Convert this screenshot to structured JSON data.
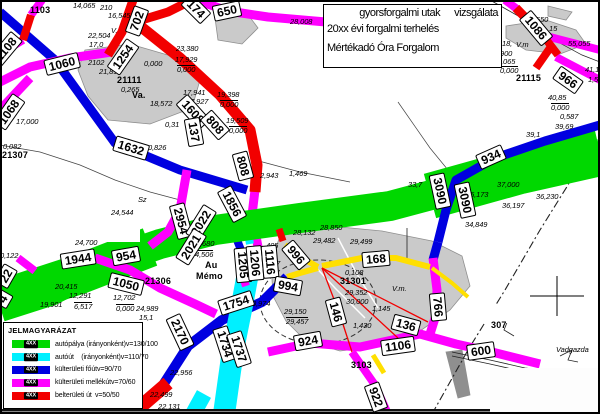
{
  "title_box": {
    "line1_left": "gyorsforgalmi utak",
    "line1_right": "vizsgálata",
    "line2": "20xx évi forgalmi terhelés",
    "line3": "Mértékadó Óra Forgalom"
  },
  "legend": {
    "title": "JELMAGYARÁZAT",
    "sample_label": "4XX",
    "items": [
      {
        "color": "green",
        "label": "autópálya (irányonként)",
        "speed": "v=130/100"
      },
      {
        "color": "cyan",
        "label": "autóút    (irányonként)",
        "speed": "v=110/70"
      },
      {
        "color": "blue",
        "label": "külterületi főút",
        "speed": "v=90/70"
      },
      {
        "color": "magenta",
        "label": "külterületi mellékút",
        "speed": "v=70/60"
      },
      {
        "color": "red",
        "label": "belterületi út",
        "speed": "v=50/50"
      }
    ]
  },
  "colors": {
    "green": "#00d800",
    "cyan": "#00f0ff",
    "blue": "#0000e0",
    "magenta": "#ff00ff",
    "red": "#f20000",
    "yellow": "#ffdf00",
    "gray_fill": "#cacaca",
    "gray_stroke": "#8f8f8f"
  },
  "map": {
    "gray_areas": [
      {
        "p": "85,50 130,44 178,58 200,80 192,108 150,124 108,120 88,96 78,70"
      },
      {
        "p": "215,18 246,12 258,28 242,44 218,40"
      },
      {
        "p": "506,26 546,20 576,30 586,44 560,54 526,50 506,38"
      },
      {
        "p": "548,6 572,12 566,20 548,16"
      },
      {
        "p": "280,236 330,226 382,231 432,241 462,256 470,286 450,310 420,331 380,346 340,351 306,341 286,321 273,296 271,262"
      },
      {
        "p": "446,352 462,350 466,372 470,395 458,398 452,375",
        "f": "#8f8f8f"
      },
      {
        "p": "100,386 128,386 138,400 124,414 100,414"
      }
    ],
    "dash_ring": {
      "cx": 318,
      "cy": 302,
      "rx": 58,
      "ry": 42
    },
    "thin_lines": [
      {
        "p": "490,0 520,17 545,35"
      },
      {
        "p": "545,35 582,55 600,62",
        "w": 0.7
      },
      {
        "p": "407,228 407,262",
        "w": 0.8
      },
      {
        "p": "0,145 40,152 80,165 115,180 150,192 180,200",
        "w": 0.7,
        "c": "#444"
      },
      {
        "p": "255,160 300,172 350,182",
        "w": 0.7,
        "c": "#444"
      },
      {
        "p": "398,102 430,148 448,170",
        "w": 0.7,
        "c": "#444"
      },
      {
        "p": "498,312 508,320 504,330 514,336",
        "w": 0.8
      },
      {
        "p": "560,356 572,350 568,360 578,362",
        "w": 0.8
      },
      {
        "p": "452,352 490,360 525,368 552,371",
        "w": 0.8
      },
      {
        "p": "452,356 490,364 525,372 550,375",
        "w": 0.8
      },
      {
        "p": "300,250 335,288 365,318",
        "c": "#fff",
        "w": 1.5
      },
      {
        "p": "338,238 358,276 378,308",
        "c": "#fff",
        "w": 1.5
      },
      {
        "p": "432,414 468,350 505,290 540,230 568,185 590,142",
        "w": 1.1,
        "d": "8 3 2 3"
      }
    ],
    "roads": [
      {
        "k": "magenta",
        "w": 9,
        "p": "255,190 252,215 258,247"
      },
      {
        "k": "blue",
        "w": 8,
        "p": "233,230 245,260"
      },
      {
        "k": "cyan",
        "w": 8,
        "p": "247,228 250,244"
      },
      {
        "k": "green",
        "w": 40,
        "p": "0,300 80,274 150,247"
      },
      {
        "k": "green",
        "w": 30,
        "p": "0,307 50,291 105,263 160,244 215,230 300,218 390,206 480,182 545,163 600,154"
      },
      {
        "k": "green",
        "w": 46,
        "p": "430,196 520,171 600,153"
      },
      {
        "k": "blue",
        "w": 9,
        "p": "0,12 55,60 115,143 180,170 247,190"
      },
      {
        "k": "blue",
        "w": 9,
        "p": "600,125 545,141 495,158 456,180 446,210 438,242"
      },
      {
        "k": "blue",
        "w": 9,
        "p": "438,242 433,260"
      },
      {
        "k": "blue",
        "w": 10,
        "p": "163,385 188,346 222,320 262,302 287,277"
      },
      {
        "k": "cyan",
        "w": 22,
        "p": "250,262 243,300 233,350 224,414"
      },
      {
        "k": "cyan",
        "w": 16,
        "p": "204,394 193,414"
      },
      {
        "k": "magenta",
        "w": 8,
        "p": "42,0 31,15"
      },
      {
        "k": "magenta",
        "w": 8,
        "p": "23,40 10,48 0,51"
      },
      {
        "k": "magenta",
        "w": 9,
        "p": "0,82 30,67 70,58 112,52"
      },
      {
        "k": "magenta",
        "w": 9,
        "p": "196,0 228,11 268,17 326,22"
      },
      {
        "k": "magenta",
        "w": 9,
        "p": "30,78 0,110"
      },
      {
        "k": "magenta",
        "w": 9,
        "p": "95,258 130,270 160,288 195,304 216,314"
      },
      {
        "k": "magenta",
        "w": 9,
        "p": "187,170 180,210 168,232 150,246"
      },
      {
        "k": "magenta",
        "w": 9,
        "p": "268,352 310,343 360,347 420,334 456,344 492,352 540,364"
      },
      {
        "k": "magenta",
        "w": 8,
        "p": "352,352 375,385 388,414"
      },
      {
        "k": "magenta",
        "w": 9,
        "p": "433,258 437,290 436,315 430,334"
      },
      {
        "k": "magenta",
        "w": 8,
        "p": "556,57 600,80"
      },
      {
        "k": "magenta",
        "w": 8,
        "p": "546,36 600,50"
      },
      {
        "k": "magenta",
        "w": 8,
        "p": "505,0 517,9"
      },
      {
        "k": "magenta",
        "w": 8,
        "p": "240,268 246,286"
      },
      {
        "k": "magenta",
        "w": 8,
        "p": "18,258 35,271"
      },
      {
        "k": "red",
        "w": 11,
        "p": "135,22 180,58 220,95 250,130 257,165 255,192"
      },
      {
        "k": "red",
        "w": 9,
        "p": "192,0 168,12 135,22"
      },
      {
        "k": "red",
        "w": 8,
        "p": "31,15 23,40"
      },
      {
        "k": "red",
        "w": 8,
        "p": "12,46 0,53"
      },
      {
        "k": "red",
        "w": 9,
        "p": "108,55 122,32 133,0"
      },
      {
        "k": "red",
        "w": 9,
        "p": "516,8 545,38"
      },
      {
        "k": "red",
        "w": 8,
        "p": "545,38 558,55"
      },
      {
        "k": "red",
        "w": 8,
        "p": "550,48 536,68"
      },
      {
        "k": "red",
        "w": 14,
        "p": "132,414 168,383"
      },
      {
        "k": "red",
        "w": 7,
        "p": "279,229 283,241"
      },
      {
        "k": "yellow",
        "w": 6,
        "p": "322,266 362,258 396,258 430,267"
      },
      {
        "k": "yellow",
        "w": 6,
        "p": "285,245 302,258 318,267"
      },
      {
        "k": "yellow",
        "w": 5,
        "p": "373,355 384,373"
      },
      {
        "k": "yellow",
        "w": 6,
        "p": "318,268 300,273 287,277"
      },
      {
        "k": "yellow",
        "w": 4,
        "p": "432,268 452,283 468,297"
      },
      {
        "k": "red",
        "w": 1.3,
        "p": "322,268 428,322"
      },
      {
        "k": "red",
        "w": 1.3,
        "p": "322,268 398,338"
      },
      {
        "k": "red",
        "w": 1.3,
        "p": "322,268 340,315 352,352"
      }
    ],
    "overlays": [
      {
        "x": 30,
        "y": 218,
        "w": 110,
        "h": 24
      },
      {
        "x": 483,
        "y": 305,
        "w": 34,
        "h": 18
      },
      {
        "x": 0,
        "y": 409,
        "w": 600,
        "h": 2,
        "f": "#111111"
      },
      {
        "x": 0,
        "y": 411,
        "w": 600,
        "h": 3,
        "f": "#888888"
      },
      {
        "x": 490,
        "y": 368,
        "w": 110,
        "h": 46,
        "f": "#fdfdfd"
      }
    ],
    "top_lines": [
      {
        "p": "530,296 584,296",
        "w": 1
      },
      {
        "p": "557,276 557,316",
        "w": 1
      }
    ],
    "road_labels": [
      {
        "t": "1086",
        "x": 536,
        "y": 28,
        "r": 50
      },
      {
        "t": "966",
        "x": 568,
        "y": 80,
        "r": 35
      },
      {
        "t": "650",
        "x": 227,
        "y": 11,
        "r": -12
      },
      {
        "t": "174",
        "x": 196,
        "y": 9,
        "r": 45
      },
      {
        "t": "702",
        "x": 137,
        "y": 21,
        "r": -70
      },
      {
        "t": "1254",
        "x": 123,
        "y": 57,
        "r": -55
      },
      {
        "t": "1060",
        "x": 62,
        "y": 64,
        "r": -14
      },
      {
        "t": "1108",
        "x": 6,
        "y": 49,
        "r": -50
      },
      {
        "t": "1068",
        "x": 9,
        "y": 112,
        "r": -55
      },
      {
        "t": "1632",
        "x": 131,
        "y": 148,
        "r": 17
      },
      {
        "t": "1608",
        "x": 193,
        "y": 112,
        "r": 48
      },
      {
        "t": "808",
        "x": 215,
        "y": 125,
        "r": 48
      },
      {
        "t": "137",
        "x": 194,
        "y": 132,
        "r": 80
      },
      {
        "t": "808",
        "x": 243,
        "y": 166,
        "r": 75
      },
      {
        "t": "1856",
        "x": 232,
        "y": 204,
        "r": 62
      },
      {
        "t": "2954",
        "x": 181,
        "y": 221,
        "r": 75
      },
      {
        "t": "2022",
        "x": 201,
        "y": 223,
        "r": -58
      },
      {
        "t": "2021",
        "x": 191,
        "y": 247,
        "r": -58
      },
      {
        "t": "1944",
        "x": 78,
        "y": 259,
        "r": -9
      },
      {
        "t": "954",
        "x": 126,
        "y": 256,
        "r": -10
      },
      {
        "t": "1050",
        "x": 126,
        "y": 284,
        "r": 14
      },
      {
        "t": "22",
        "x": 6,
        "y": 276,
        "r": -60
      },
      {
        "t": "4",
        "x": 3,
        "y": 299,
        "r": -60
      },
      {
        "t": "2170",
        "x": 180,
        "y": 332,
        "r": 65
      },
      {
        "t": "1754",
        "x": 236,
        "y": 303,
        "r": -18
      },
      {
        "t": "1734",
        "x": 225,
        "y": 344,
        "r": 72
      },
      {
        "t": "1737",
        "x": 239,
        "y": 349,
        "r": 72
      },
      {
        "t": "1205",
        "x": 243,
        "y": 265,
        "r": 85
      },
      {
        "t": "1206",
        "x": 255,
        "y": 263,
        "r": 85
      },
      {
        "t": "1116",
        "x": 270,
        "y": 262,
        "r": 85
      },
      {
        "t": "996",
        "x": 296,
        "y": 255,
        "r": 50
      },
      {
        "t": "994",
        "x": 288,
        "y": 286,
        "r": 10
      },
      {
        "t": "168",
        "x": 376,
        "y": 259,
        "r": -5
      },
      {
        "t": "146",
        "x": 336,
        "y": 312,
        "r": 75
      },
      {
        "t": "136",
        "x": 406,
        "y": 325,
        "r": 15
      },
      {
        "t": "766",
        "x": 438,
        "y": 307,
        "r": 85
      },
      {
        "t": "924",
        "x": 308,
        "y": 341,
        "r": -10
      },
      {
        "t": "1106",
        "x": 398,
        "y": 346,
        "r": -8
      },
      {
        "t": "600",
        "x": 481,
        "y": 351,
        "r": -8
      },
      {
        "t": "922",
        "x": 376,
        "y": 397,
        "r": 70
      },
      {
        "t": "934",
        "x": 491,
        "y": 157,
        "r": -24
      },
      {
        "t": "3090",
        "x": 440,
        "y": 191,
        "r": 78
      },
      {
        "t": "3090",
        "x": 465,
        "y": 200,
        "r": 78
      }
    ],
    "texts": [
      {
        "t": "1103",
        "x": 30,
        "y": 6,
        "s": "b"
      },
      {
        "t": "14,065",
        "x": 73,
        "y": 2
      },
      {
        "t": "210",
        "x": 100,
        "y": 4
      },
      {
        "t": "16,545",
        "x": 108,
        "y": 12
      },
      {
        "t": "V.",
        "x": 111,
        "y": 27
      },
      {
        "t": "22,504",
        "x": 88,
        "y": 32
      },
      {
        "t": "17,0",
        "x": 89,
        "y": 41
      },
      {
        "t": "2102",
        "x": 88,
        "y": 59
      },
      {
        "t": "0,000",
        "x": 144,
        "y": 60
      },
      {
        "t": "23,380",
        "x": 176,
        "y": 45
      },
      {
        "t": "17,929",
        "x": 175,
        "y": 56
      },
      {
        "t": "0,000",
        "x": 177,
        "y": 65,
        "s": "if"
      },
      {
        "t": "28,008",
        "x": 290,
        "y": 18
      },
      {
        "t": "550",
        "x": 536,
        "y": 16
      },
      {
        "t": "15",
        "x": 549,
        "y": 25
      },
      {
        "t": "55,055",
        "x": 568,
        "y": 40
      },
      {
        "t": "18,",
        "x": 502,
        "y": 40
      },
      {
        "t": "V.m",
        "x": 516,
        "y": 41
      },
      {
        "t": "900",
        "x": 500,
        "y": 50
      },
      {
        "t": "3,065",
        "x": 497,
        "y": 58
      },
      {
        "t": "0,000",
        "x": 500,
        "y": 66,
        "s": "if"
      },
      {
        "t": "21115",
        "x": 516,
        "y": 74,
        "s": "b"
      },
      {
        "t": "41,1",
        "x": 585,
        "y": 66
      },
      {
        "t": "1,5",
        "x": 588,
        "y": 76
      },
      {
        "t": "40,85",
        "x": 548,
        "y": 94
      },
      {
        "t": "0,000",
        "x": 551,
        "y": 103,
        "s": "if"
      },
      {
        "t": "0,587",
        "x": 560,
        "y": 113
      },
      {
        "t": "39,69",
        "x": 555,
        "y": 123
      },
      {
        "t": "39,1",
        "x": 526,
        "y": 131
      },
      {
        "t": "21,892",
        "x": 99,
        "y": 68
      },
      {
        "t": "21111",
        "x": 117,
        "y": 76,
        "s": "b"
      },
      {
        "t": "0,265",
        "x": 121,
        "y": 86
      },
      {
        "t": "Va.",
        "x": 132,
        "y": 91,
        "s": "b"
      },
      {
        "t": "17,941",
        "x": 183,
        "y": 89
      },
      {
        "t": "17,927",
        "x": 186,
        "y": 98
      },
      {
        "t": "19,398",
        "x": 217,
        "y": 91
      },
      {
        "t": "0,000",
        "x": 220,
        "y": 100,
        "s": "if"
      },
      {
        "t": "19,509",
        "x": 226,
        "y": 117
      },
      {
        "t": "0,000",
        "x": 229,
        "y": 126,
        "s": "if"
      },
      {
        "t": "18,572",
        "x": 150,
        "y": 100
      },
      {
        "t": "0,31",
        "x": 165,
        "y": 121
      },
      {
        "t": "0,826",
        "x": 148,
        "y": 144
      },
      {
        "t": "0,082",
        "x": 3,
        "y": 143
      },
      {
        "t": "21307",
        "x": 2,
        "y": 151,
        "s": "b"
      },
      {
        "t": "17,000",
        "x": 16,
        "y": 118
      },
      {
        "t": "2,943",
        "x": 260,
        "y": 172
      },
      {
        "t": "1,469",
        "x": 289,
        "y": 170
      },
      {
        "t": "Sz",
        "x": 138,
        "y": 196
      },
      {
        "t": "24,544",
        "x": 111,
        "y": 209
      },
      {
        "t": "0,122",
        "x": 0,
        "y": 252
      },
      {
        "t": "24,700",
        "x": 75,
        "y": 239
      },
      {
        "t": "20,415",
        "x": 55,
        "y": 283
      },
      {
        "t": "12,291",
        "x": 69,
        "y": 292
      },
      {
        "t": "6,517",
        "x": 74,
        "y": 302,
        "s": "if"
      },
      {
        "t": "19,901",
        "x": 40,
        "y": 301
      },
      {
        "t": "12,702",
        "x": 113,
        "y": 294
      },
      {
        "t": "0,000",
        "x": 116,
        "y": 304,
        "s": "if"
      },
      {
        "t": "24,989",
        "x": 136,
        "y": 305
      },
      {
        "t": "15,1",
        "x": 139,
        "y": 314
      },
      {
        "t": "21306",
        "x": 145,
        "y": 277,
        "s": "b"
      },
      {
        "t": "4,680",
        "x": 196,
        "y": 240
      },
      {
        "t": "4,506",
        "x": 195,
        "y": 250,
        "s": "if"
      },
      {
        "t": "Au",
        "x": 205,
        "y": 261,
        "s": "b"
      },
      {
        "t": "Mémo",
        "x": 196,
        "y": 272,
        "s": "b"
      },
      {
        "t": "28,850",
        "x": 320,
        "y": 224
      },
      {
        "t": "28,132",
        "x": 293,
        "y": 229
      },
      {
        "t": "405",
        "x": 266,
        "y": 242
      },
      {
        "t": "29,482",
        "x": 313,
        "y": 237
      },
      {
        "t": "29,499",
        "x": 350,
        "y": 238
      },
      {
        "t": "857",
        "x": 268,
        "y": 260
      },
      {
        "t": "0,974",
        "x": 252,
        "y": 300
      },
      {
        "t": "29,150",
        "x": 284,
        "y": 308
      },
      {
        "t": "29,457",
        "x": 286,
        "y": 317,
        "s": "if"
      },
      {
        "t": "0,108",
        "x": 345,
        "y": 269
      },
      {
        "t": "31301",
        "x": 340,
        "y": 277,
        "s": "b"
      },
      {
        "t": "29,352",
        "x": 345,
        "y": 289
      },
      {
        "t": "30,000",
        "x": 346,
        "y": 298
      },
      {
        "t": "1,145",
        "x": 372,
        "y": 305
      },
      {
        "t": "1,430",
        "x": 353,
        "y": 322
      },
      {
        "t": "3103",
        "x": 351,
        "y": 361,
        "s": "b"
      },
      {
        "t": "V.m.",
        "x": 392,
        "y": 285
      },
      {
        "t": "307",
        "x": 491,
        "y": 321,
        "s": "b"
      },
      {
        "t": "Vadgazda",
        "x": 556,
        "y": 346
      },
      {
        "t": "22,956",
        "x": 170,
        "y": 369
      },
      {
        "t": "22,499",
        "x": 150,
        "y": 391
      },
      {
        "t": "22,131",
        "x": 158,
        "y": 403
      },
      {
        "t": "33,7",
        "x": 408,
        "y": 181
      },
      {
        "t": "37,000",
        "x": 497,
        "y": 181
      },
      {
        "t": "35,173",
        "x": 466,
        "y": 191
      },
      {
        "t": "36,230",
        "x": 536,
        "y": 193
      },
      {
        "t": "36,197",
        "x": 502,
        "y": 202
      },
      {
        "t": "34,849",
        "x": 465,
        "y": 221
      }
    ]
  }
}
